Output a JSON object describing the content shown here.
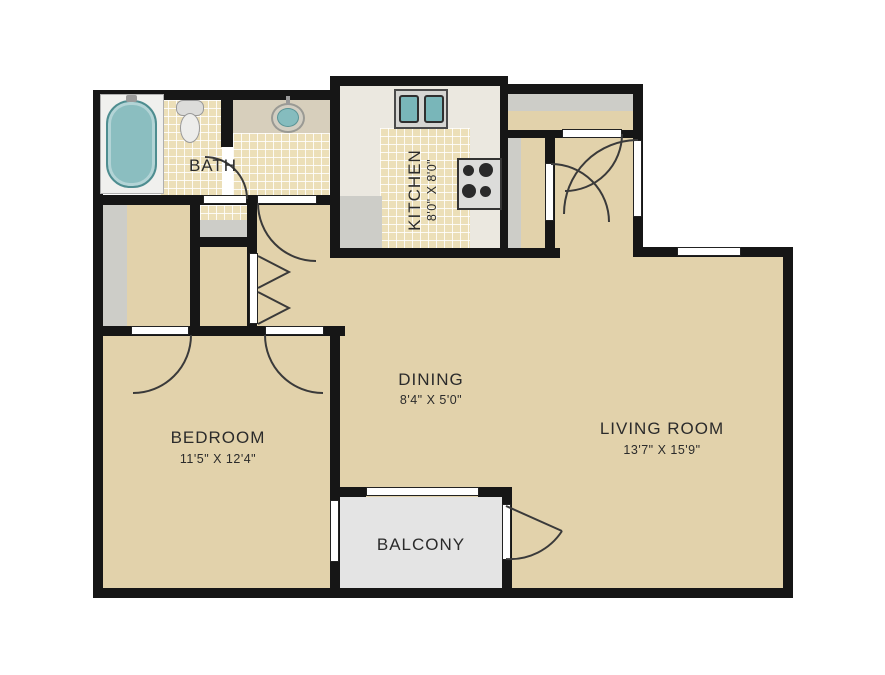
{
  "title": "Apartment Floor Plan",
  "rooms": {
    "bath": {
      "label": "BATH",
      "dims": ""
    },
    "kitchen": {
      "label": "KITCHEN",
      "dims": "8'0\" X 8'0\""
    },
    "dining": {
      "label": "DINING",
      "dims": "8'4\" X 5'0\""
    },
    "bedroom": {
      "label": "BEDROOM",
      "dims": "11'5\" X 12'4\""
    },
    "living": {
      "label": "LIVING ROOM",
      "dims": "13'7\" X 15'9\""
    },
    "balcony": {
      "label": "BALCONY",
      "dims": ""
    }
  },
  "colors": {
    "wall": "#161616",
    "floor_tan": "#e2d2ab",
    "tile": "#ecdfb8",
    "kitchen_floor": "#ebe8e0",
    "balcony_floor": "#e4e4e4",
    "shelf_grey": "#cdcdc8",
    "fixture_teal": "#8bbec0",
    "text": "#2b2b2b"
  }
}
